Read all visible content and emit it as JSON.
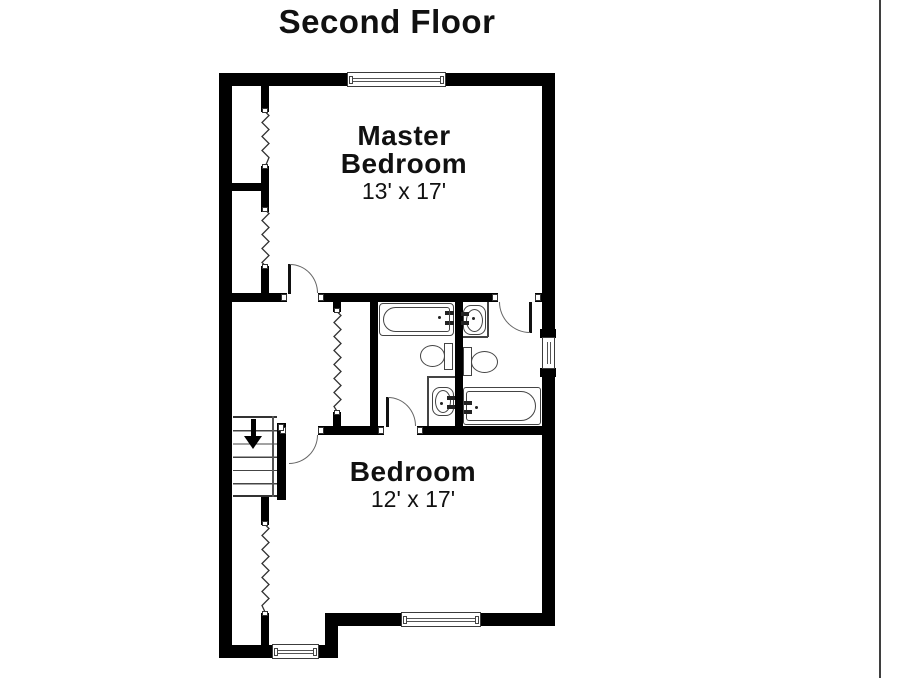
{
  "title": "Second Floor",
  "rooms": {
    "master_bedroom": {
      "label_line1": "Master",
      "label_line2": "Bedroom",
      "dimensions": "13' x 17'"
    },
    "bedroom": {
      "label": "Bedroom",
      "dimensions": "12' x 17'"
    }
  },
  "stairs": {
    "direction_icon": "down-arrow"
  },
  "fixtures": {
    "hall_bathroom": [
      "bathtub",
      "toilet",
      "sink"
    ],
    "master_bathroom": [
      "sink",
      "toilet",
      "bathtub"
    ]
  },
  "colors": {
    "walls": "#000000",
    "fixture_lines": "#444444",
    "door_arcs": "#666666",
    "text": "#111111",
    "background": "#ffffff",
    "right_edge_line": "#3f3f3f"
  }
}
